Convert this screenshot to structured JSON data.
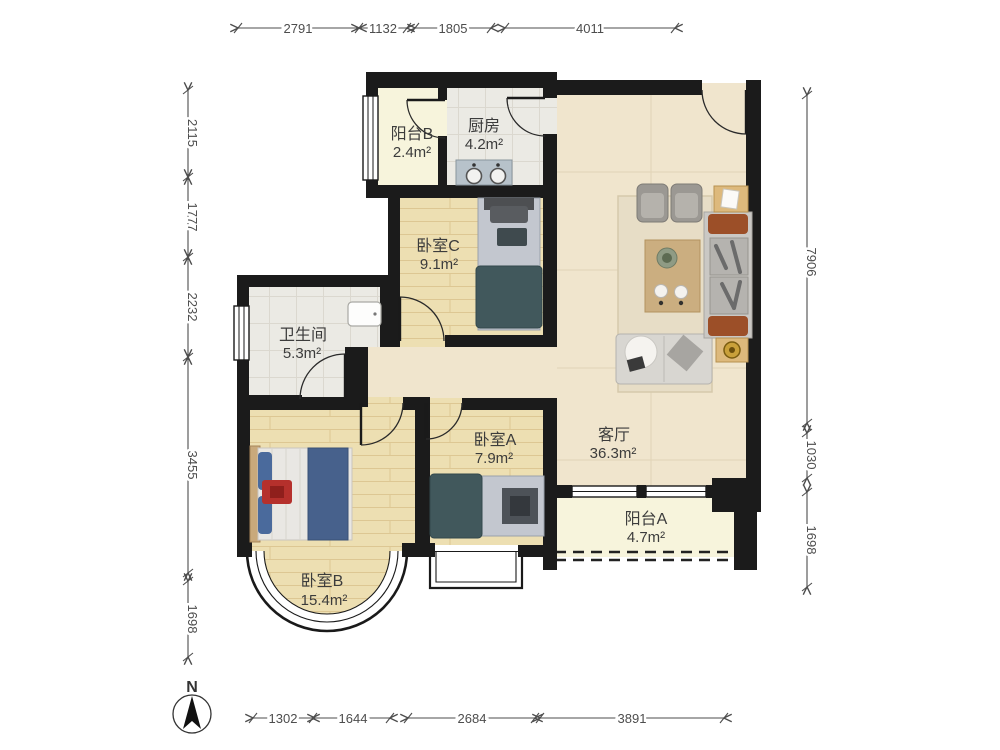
{
  "plan": {
    "rooms": [
      {
        "name": "阳台B",
        "area": "2.4m²"
      },
      {
        "name": "厨房",
        "area": "4.2m²"
      },
      {
        "name": "卧室C",
        "area": "9.1m²"
      },
      {
        "name": "卫生间",
        "area": "5.3m²"
      },
      {
        "name": "卧室A",
        "area": "7.9m²"
      },
      {
        "name": "客厅",
        "area": "36.3m²"
      },
      {
        "name": "卧室B",
        "area": "15.4m²"
      },
      {
        "name": "阳台A",
        "area": "4.7m²"
      }
    ],
    "dimensions": {
      "top": [
        "2791",
        "1132",
        "1805",
        "4011"
      ],
      "left": [
        "2115",
        "1777",
        "2232",
        "3455",
        "1698"
      ],
      "right": [
        "7906",
        "1030",
        "1698"
      ],
      "bottom": [
        "1302",
        "1644",
        "2684",
        "3891"
      ]
    },
    "compass": {
      "label": "N"
    },
    "colors": {
      "wall": "#1b1b1b",
      "wood": "#eddfb2",
      "marble": "#f0e5cd",
      "tile": "#ebeae4",
      "balcony": "#f7f4dc",
      "label_text": "#3c3c3c",
      "dimension": "#4d4d4d"
    }
  }
}
